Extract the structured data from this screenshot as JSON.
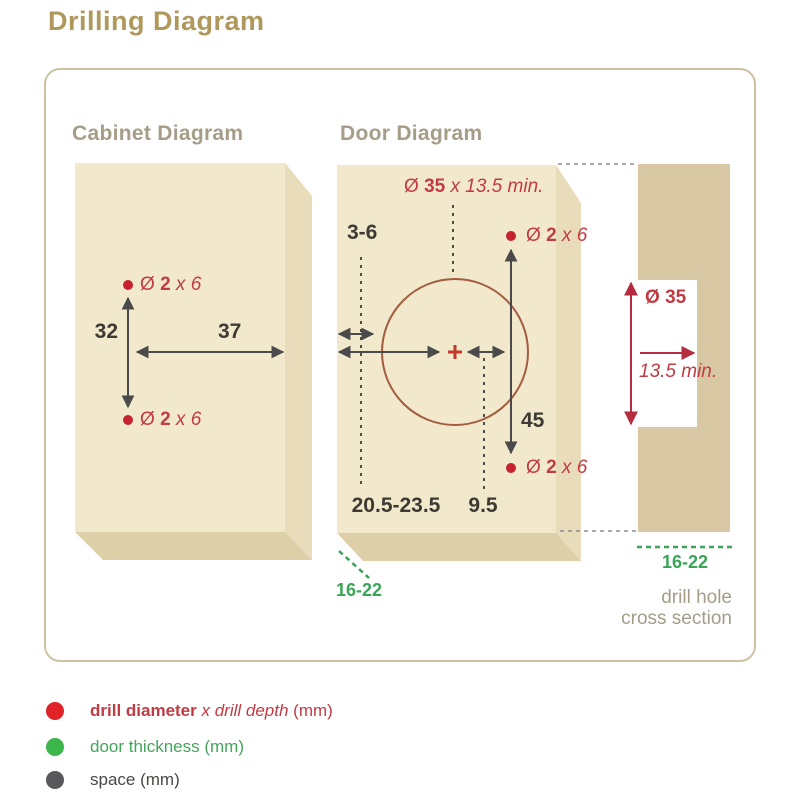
{
  "page_title": "Drilling Diagram",
  "cabinet": {
    "heading": "Cabinet Diagram",
    "hole_top": {
      "prefix": "Ø ",
      "bold": "2",
      "italic": " x 6"
    },
    "hole_bottom": {
      "prefix": "Ø ",
      "bold": "2",
      "italic": " x 6"
    },
    "dim_vertical": "32",
    "dim_horizontal": "37"
  },
  "door": {
    "heading": "Door Diagram",
    "cup_label": {
      "prefix": "Ø ",
      "bold": "35",
      "italic": " x 13.5 min."
    },
    "hole_top": {
      "prefix": "Ø ",
      "bold": "2",
      "italic": " x 6"
    },
    "hole_bottom": {
      "prefix": "Ø ",
      "bold": "2",
      "italic": " x 6"
    },
    "dim_edge_gap": "3-6",
    "dim_cup_center": "20.5-23.5",
    "dim_offset": "9.5",
    "dim_screw_span": "45",
    "dim_thickness": "16-22"
  },
  "cross_section": {
    "dim_diameter": {
      "prefix": "Ø ",
      "bold": "35"
    },
    "dim_depth": "13.5 min.",
    "dim_thickness": "16-22",
    "caption_line1": "drill hole",
    "caption_line2": "cross section"
  },
  "legend": {
    "items": [
      {
        "dot_color": "#e02229",
        "bold": "drill diameter",
        "italic": " x drill depth",
        "suffix": " (mm)"
      },
      {
        "dot_color": "#3cb54b",
        "label": "door thickness (mm)"
      },
      {
        "dot_color": "#58585a",
        "label": "space (mm)"
      }
    ]
  },
  "colors": {
    "accent_gold": "#b0985c",
    "heading_gray": "#a69d89",
    "dimension_red": "#c13b44",
    "dot_red": "#c62231",
    "thickness_green": "#3aa558",
    "space_gray": "#4a4a4a",
    "panel_front": "#f2e8cb",
    "panel_side": "#e9dcba",
    "panel_bottom": "#ddcfa8",
    "cross_section_bar": "#d9c8a4",
    "frame_border": "#cdc3a3"
  }
}
